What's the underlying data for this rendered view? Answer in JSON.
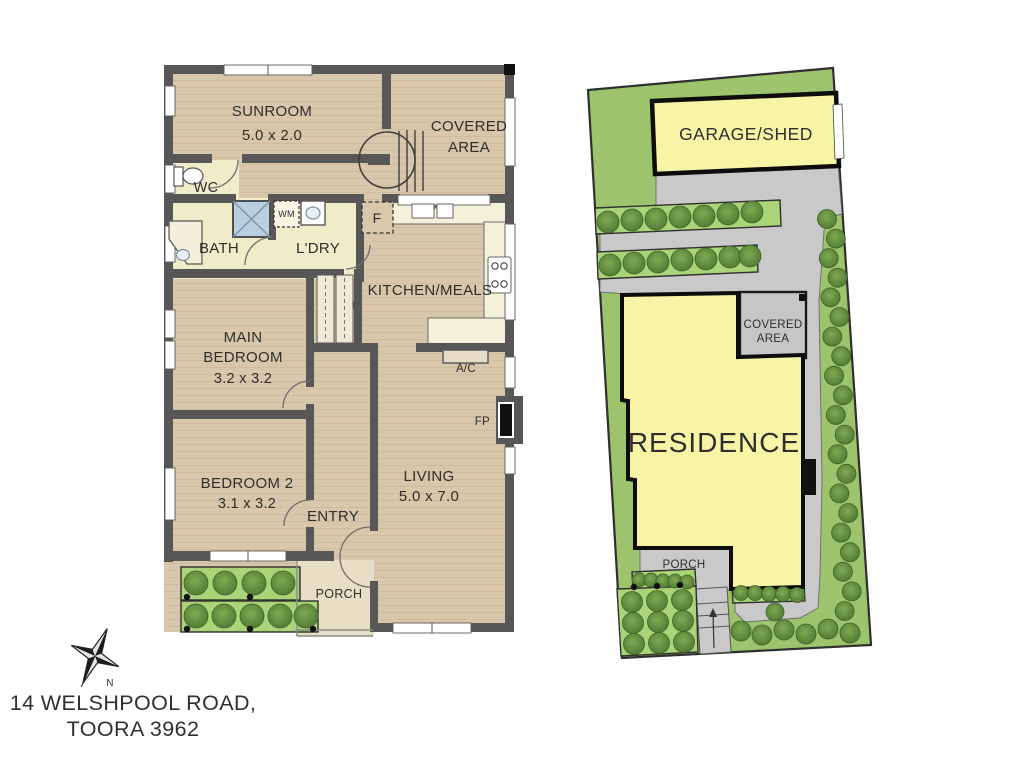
{
  "floor_plan": {
    "labels": {
      "sunroom": "SUNROOM",
      "sunroom_dim": "5.0 x 2.0",
      "covered_line1": "COVERED",
      "covered_line2": "AREA",
      "wc": "WC",
      "bath": "BATH",
      "washing_machine": "WM",
      "laundry": "L'DRY",
      "fridge": "F",
      "kitchen": "KITCHEN/MEALS",
      "ac": "A/C",
      "main_bedroom_line1": "MAIN",
      "main_bedroom_line2": "BEDROOM",
      "main_bedroom_dim": "3.2 x 3.2",
      "bedroom2": "BEDROOM 2",
      "bedroom2_dim": "3.1 x 3.2",
      "fireplace": "FP",
      "living": "LIVING",
      "living_dim": "5.0 x 7.0",
      "entry": "ENTRY",
      "porch": "PORCH"
    }
  },
  "site_plan": {
    "labels": {
      "garage": "GARAGE/SHED",
      "covered_line1": "COVERED",
      "covered_line2": "AREA",
      "residence": "RESIDENCE",
      "porch": "PORCH"
    }
  },
  "footer": {
    "address_line1": "14 WELSHPOOL ROAD,",
    "address_line2": "TOORA 3962",
    "compass_north": "N"
  },
  "colors": {
    "wall": "#575757",
    "floor_tan": "#d9c7ab",
    "floor_tan_line": "#cfbc9e",
    "floor_pale": "#efecca",
    "bench_cream": "#f4f1da",
    "shower_blue": "#b9cede",
    "grass": "#9dc36d",
    "hedge": "#abd377",
    "paving": "#c9c9c9",
    "building_yellow": "#f8f4a6",
    "tree_dark": "#4f7a33",
    "tree_light": "#7fa951",
    "ink": "#2e2e2e"
  }
}
